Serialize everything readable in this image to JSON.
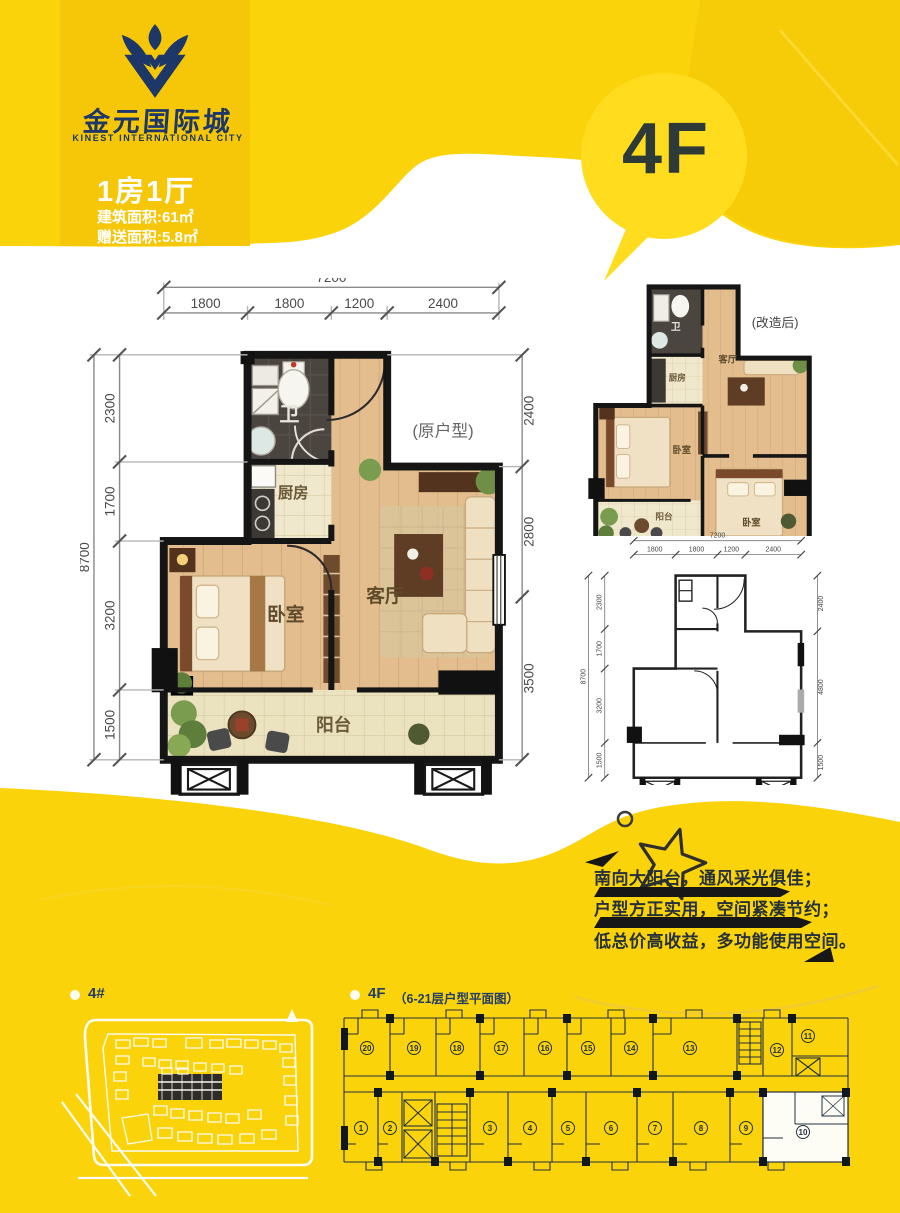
{
  "colors": {
    "yellow": "#fbd30b",
    "card_gold": "#f5c708",
    "bubble": "#ffdd1e",
    "navy": "#1c3768",
    "dark_text": "#25313a",
    "wall": "#151515"
  },
  "brand": {
    "logo_cn": "金元国际城",
    "logo_en": "KINEST INTERNATIONAL CITY"
  },
  "unit": {
    "type_label": "1房1厅",
    "area_built": "建筑面积:61㎡",
    "area_gift": "赠送面积:5.8㎡"
  },
  "floor_badge": "4F",
  "plans": {
    "original": {
      "tag": "(原户型)",
      "rooms": {
        "bath": "卫",
        "kitchen": "厨房",
        "bedroom": "卧室",
        "living": "客厅",
        "balcony": "阳台"
      },
      "dims": {
        "top_total": "7200",
        "top": [
          "1800",
          "1800",
          "1200",
          "2400"
        ],
        "left_total": "8700",
        "left": [
          "2300",
          "1700",
          "3200",
          "1500"
        ],
        "right": [
          "2400",
          "2800",
          "3500"
        ]
      }
    },
    "renovated": {
      "tag": "(改造后)",
      "rooms": {
        "bath": "卫",
        "kitchen": "厨房",
        "living": "客厅",
        "bedroom1": "卧室",
        "bedroom2": "卧室",
        "balcony": "阳台"
      }
    },
    "schematic": {
      "dims": {
        "top_total": "7200",
        "top": [
          "1800",
          "1800",
          "1200",
          "2400"
        ],
        "left_total": "8700",
        "left": [
          "2300",
          "1700",
          "3200",
          "1500"
        ],
        "right": [
          "2400",
          "4800",
          "1500"
        ]
      }
    }
  },
  "selling_points": [
    "南向大阳台，通风采光俱佳；",
    "户型方正实用，空间紧凑节约；",
    "低总价高收益，多功能使用空间。"
  ],
  "site_plan": {
    "label": "4#"
  },
  "floor_plate": {
    "label_floor": "4F",
    "label_desc": "（6-21层户型平面图）",
    "units_top": [
      "20",
      "19",
      "18",
      "17",
      "16",
      "15",
      "14",
      "13",
      "12",
      "11"
    ],
    "units_bottom": [
      "1",
      "2",
      "3",
      "4",
      "5",
      "6",
      "7",
      "8",
      "9",
      "10"
    ],
    "highlight_unit": "10"
  }
}
